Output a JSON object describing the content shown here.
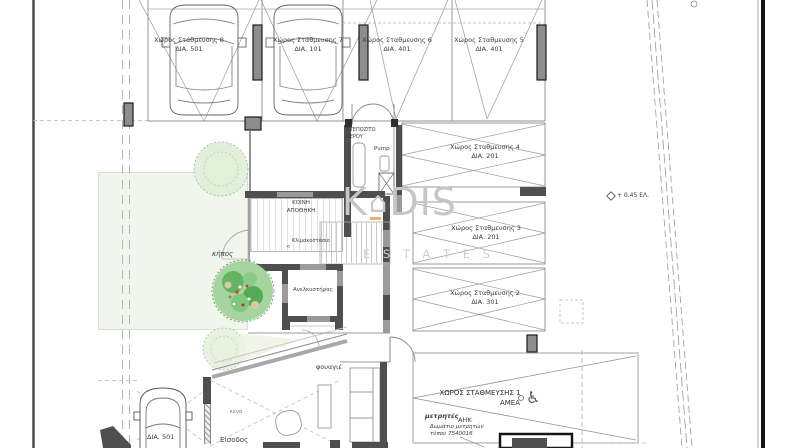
{
  "plan": {
    "type": "architectural-floor-plan",
    "level": "ground-floor-parking"
  },
  "watermark": {
    "part1": "K",
    "house_glyph": "⌂",
    "part2": "DIS",
    "subtitle": "E S T A T E S"
  },
  "parking": {
    "p8": {
      "name": "Χώρος Στάθμευσης 8",
      "dia": "ΔΙΑ. 501"
    },
    "p7": {
      "name": "Χώρος Στάθμευσης 7",
      "dia": "ΔΙΑ. 101"
    },
    "p6": {
      "name": "Χώρος Σταθμευσης 6",
      "dia": "ΔΙΑ. 401"
    },
    "p5": {
      "name": "Χώρος Σταθμευσης 5",
      "dia": "ΔΙΑ. 401"
    },
    "p4": {
      "name": "Χώρος Σταθμευσης 4",
      "dia": "ΔΙΑ. 201"
    },
    "p3": {
      "name": "Χώρος Σταθμευσης 3",
      "dia": "ΔΙΑ. 201"
    },
    "p2": {
      "name": "Χώρος Σταθμευσης 2",
      "dia": "ΔΙΑ. 301"
    },
    "p1": {
      "name": "ΧΩΡΟΣ ΣΤΑΘΜΕΥΣΗΣ 1",
      "tag": "ΑΜΕΑ"
    }
  },
  "rooms": {
    "water_tank_line1": "ΝΤΕΠΟΖΙΤΟ",
    "water_tank_line2": "ΝΕΡΟΥ",
    "pump": "Pump",
    "storage_line1": "ΚΟΙΝΗ",
    "storage_line2": "ΑΠΟΘΗΚΗ",
    "staircase": "Κλιμακοστάσιο",
    "staircase_arrow": "<",
    "elevator": "Ανελκυστήρας"
  },
  "site": {
    "garden": "κήπος",
    "void": "κενό",
    "entrance": "Είσοδος",
    "foyer": "φουαγιέ",
    "car_plate": "ΔΙΑ. 501",
    "elevation": "+ 0.45 ΕΛ.",
    "wheelchair_symbol": "♿"
  },
  "meters": {
    "line1": "μετρητές",
    "line2": "ΑΗΚ",
    "line3": "Δωμάτιο μετρητών",
    "line4": "τύπου 7540016"
  },
  "colors": {
    "wall_dark": "#4f4f4f",
    "wall_gray": "#9a9a9a",
    "line": "#8f8f8f",
    "tree_fill": "#a6d49e",
    "tree_accent": "#cc4433",
    "watermark": "#c6c6c6",
    "watermark_accent": "#d79b44",
    "border_black": "#161616"
  }
}
